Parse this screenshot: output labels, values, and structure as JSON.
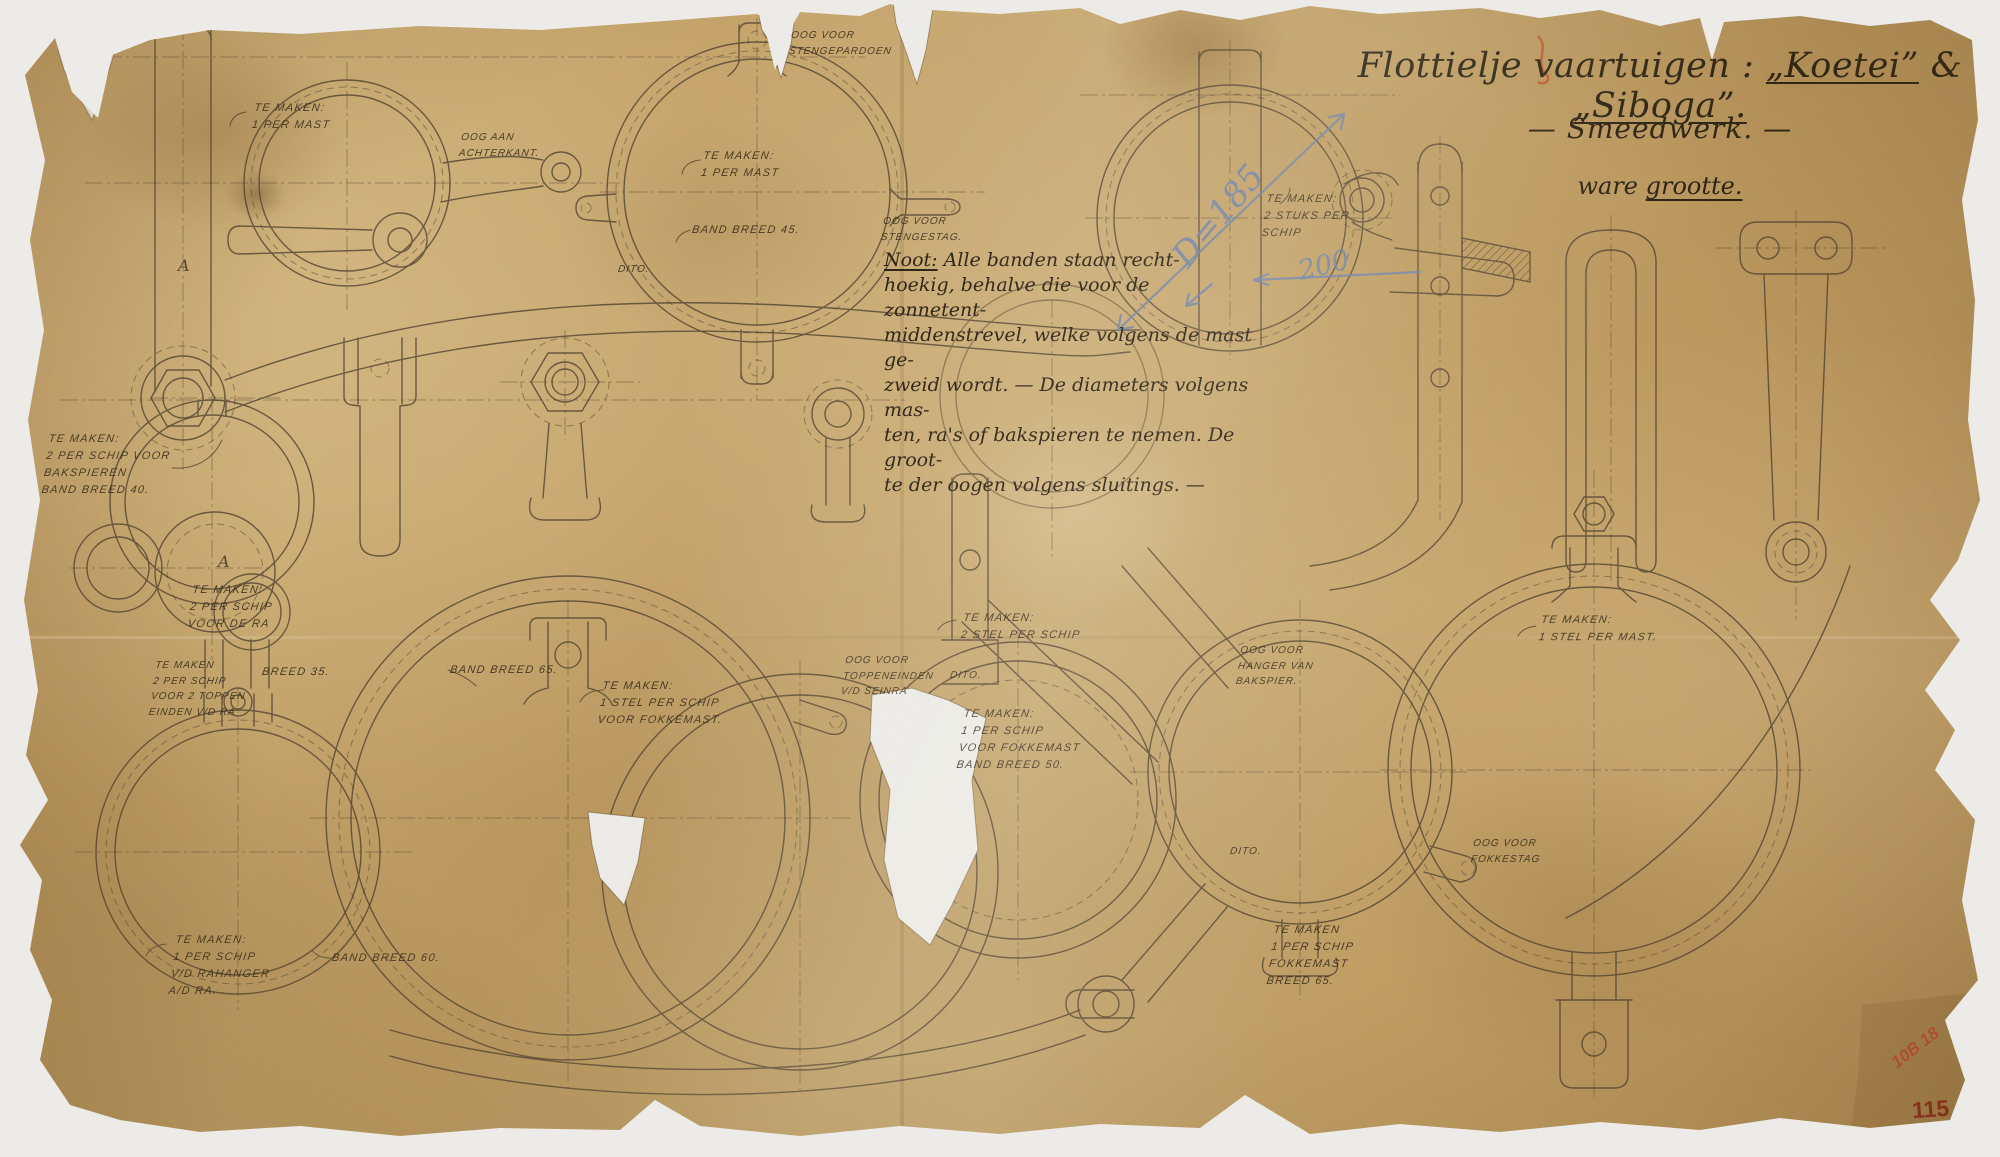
{
  "page": {
    "background_color": "#ecebe7",
    "paper_color": "#c8a76c",
    "ink_color": "#4e4130",
    "pencil_blue_color": "#6d83ad",
    "stamp_red_color": "#c04a33"
  },
  "header": {
    "title_prefix": "Flottielje vaartuigen :",
    "ship1": "„Koetei”",
    "joiner": "&",
    "ship2": "„Siboga”.",
    "subtitle": "— Smeedwerk. —",
    "scale_prefix": "ware ",
    "scale_word": "grootte."
  },
  "note": {
    "heading": "Noot:",
    "lines": [
      " Alle banden staan recht-",
      "hoekig, behalve die voor de zonnetent-",
      "middenstrevel, welke volgens de mast ge-",
      "zweid wordt. — De diameters volgens mas-",
      "ten, ra's of bakspieren te nemen. De groot-",
      "te der oogen volgens sluitings. —"
    ]
  },
  "labels": {
    "ring1_make": "TE MAKEN:\n1 PER MAST",
    "ring1_eye": "OOG AAN\nACHTERKANT.",
    "ring2_pardoen": "OOG VOOR\nSTENGEPARDOEN",
    "ring2_make": "TE MAKEN:\n1 PER MAST",
    "ring2_band": "BAND BREED 45.",
    "ring2_stag": "OOG VOOR\nSTENGESTAG.",
    "ring2_dito": "DITO.",
    "ring4_make": "TE MAKEN:\n2 STUKS PER\nSCHIP",
    "band40_make": "TE MAKEN:\n2 PER SCHIP VOOR\nBAKSPIEREN\nBAND BREED 40.",
    "mark_a1": "A",
    "mark_a2": "A",
    "ra_make": "TE MAKEN:\n2 PER SCHIP\nVOOR DE RA",
    "toppen_make": "TE MAKEN\n2 PER SCHIP\nVOOR 2 TOPPEN\nEINDEN V/D RA",
    "breed35": "BREED 35.",
    "rahanger_make": "TE MAKEN:\n1 PER SCHIP\nV/D RAHANGER\nA/D RA.",
    "band60": "BAND BREED 60.",
    "fokke_make": "TE MAKEN:\n1 STEL PER SCHIP\nVOOR FOKKEMAST.",
    "band65": "BAND BREED 65.",
    "seinra_eye": "OOG VOOR\nTOPPENEINDEN\nV/D SEINRA",
    "stel2_make": "TE MAKEN:\n2 STEL PER SCHIP",
    "bakspier_hanger_eye": "OOG VOOR\nHANGER VAN\nBAKSPIER.",
    "fokke50_make": "TE MAKEN:\n1 PER SCHIP\nVOOR FOKKEMAST\nBAND BREED 50.",
    "dito_mid": "DITO.",
    "fokkestag_eye": "OOG VOOR\nFOKKESTAG",
    "dito_bottom": "DITO.",
    "fokke65_make": "TE MAKEN\n1 PER SCHIP\nFOKKEMAST\nBREED 65.",
    "stelmast_make": "TE MAKEN:\n1 STEL PER MAST."
  },
  "pencil_annotations": {
    "diameter": "D=185",
    "dimension_200": "200"
  },
  "stamps": {
    "lot_number": "10B 18",
    "sheet_number": "115"
  }
}
